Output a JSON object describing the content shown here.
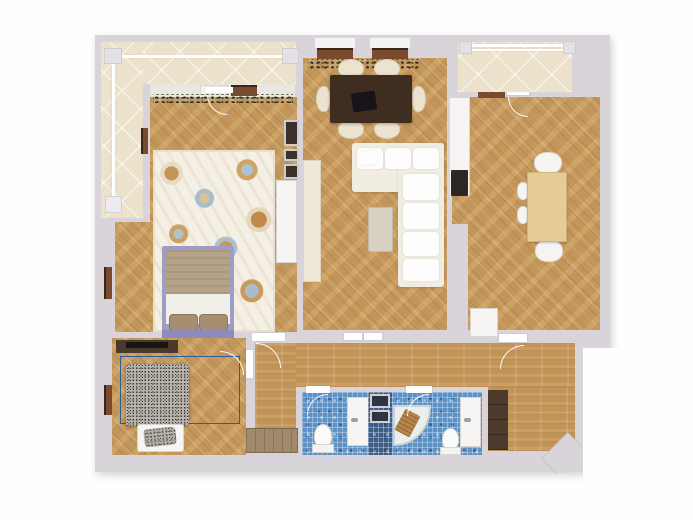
{
  "scene": {
    "kind": "apartment-floor-plan",
    "view": "top-down 3D render",
    "label": "Two-bedroom apartment floor plan"
  },
  "colors": {
    "wall": "#d8d4d9",
    "wood_floor": "#cda265",
    "balcony_tile": "#ece1ca",
    "bathroom_mosaic": "#5d92c6",
    "rug2_blue": "#3d7cb5",
    "radiator_brown": "#7a4a2e",
    "dark_cabinet": "#574433",
    "bed1_frame_purple": "#a19cc6"
  },
  "rooms": [
    {
      "id": "balcony-left",
      "label": "Left balcony (tiled, with white railing)",
      "furniture": [
        "white railing with corner posts"
      ]
    },
    {
      "id": "master-bedroom",
      "label": "Master bedroom",
      "furniture": [
        "floral area rug",
        "double bed with purple frame, beige blanket and two pillows",
        "white wardrobe",
        "built-in dark wall niche",
        "window sill with plant garland",
        "wall radiator"
      ]
    },
    {
      "id": "living-dining-room",
      "label": "Living / dining room",
      "furniture": [
        "dark wood dining table",
        "laptop on table",
        "six cream chairs",
        "L-shaped white sofa",
        "beige ottoman",
        "cream TV cabinet",
        "two radiators under windows",
        "plant garland on window sill"
      ]
    },
    {
      "id": "kitchen",
      "label": "Kitchen",
      "furniture": [
        "white counter with cooktop",
        "dark tall cabinet column",
        "fridge",
        "light wood dining table",
        "four white chairs",
        "radiator at balcony door"
      ]
    },
    {
      "id": "balcony-right",
      "label": "Right balcony (tiled, with white railing)",
      "furniture": [
        "white railing"
      ]
    },
    {
      "id": "second-bedroom",
      "label": "Second bedroom",
      "furniture": [
        "blue abstract swirl rug",
        "bed with gray tweed blanket",
        "white bench with tweed pillow",
        "dark media shelf with TV"
      ]
    },
    {
      "id": "corridor",
      "label": "Corridor",
      "furniture": [
        "wooden bench",
        "interior door swings"
      ]
    },
    {
      "id": "bathroom-1",
      "label": "Bathroom 1 (blue mosaic)",
      "furniture": [
        "toilet",
        "white washbasin cabinet"
      ]
    },
    {
      "id": "utility-shaft",
      "label": "Utility shaft between bathrooms",
      "furniture": [
        "two dark service panels"
      ]
    },
    {
      "id": "bathroom-2",
      "label": "Bathroom 2 (blue mosaic)",
      "furniture": [
        "corner shower with wooden mat",
        "toilet",
        "white washbasin cabinet"
      ]
    },
    {
      "id": "entry-hall",
      "label": "Entry hall",
      "furniture": [
        "dark wardrobe",
        "entrance arrow marker"
      ]
    }
  ]
}
